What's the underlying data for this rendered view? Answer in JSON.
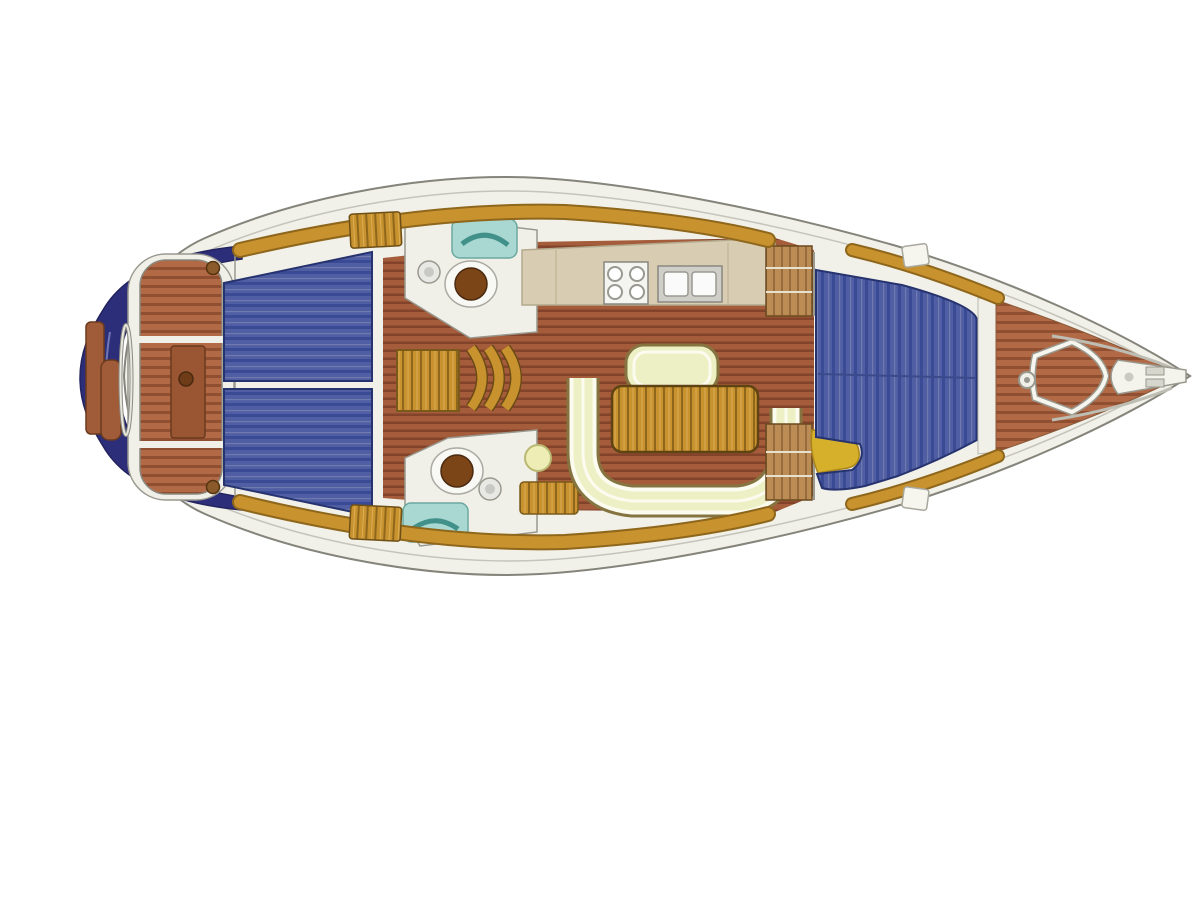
{
  "diagram": {
    "type": "sailboat-interior-floor-plan",
    "orientation": "bow-right",
    "areas": [
      "swim-platform",
      "transom",
      "cockpit",
      "helm-wheel",
      "cockpit-table",
      "aft-cabin-port-berth",
      "aft-cabin-starboard-berth",
      "head-port",
      "head-starboard",
      "galley",
      "stove",
      "double-sink",
      "companionway-steps",
      "salon-floor",
      "salon-table",
      "salon-settee",
      "settee-back-bench",
      "stool",
      "forward-wardrobe-port",
      "forward-wardrobe-starboard",
      "v-berth",
      "v-berth-seat",
      "foredeck",
      "anchor-locker-hatch",
      "windlass",
      "bow-fitting"
    ]
  },
  "colors": {
    "bg": "#ffffff",
    "hull_fill": "#f2f1e9",
    "hull_stroke": "#84847a",
    "deck_line": "#b8b7ac",
    "transom_navy": "#2d2e7a",
    "platform_navy_light": "#7078b4",
    "platform_wood": "#a05c38",
    "teak_base": "#b26a46",
    "teak_stripe": "#914f31",
    "teak_dark_box": "#9a5532",
    "floor_base": "#a55c3a",
    "floor_stripe": "#83432a",
    "berth_base": "#505fa3",
    "berth_stripe": "#3a4a94",
    "berth_light": "#707aae",
    "berth_outline": "#26336f",
    "white_detail": "#f1f0e8",
    "gray_detail": "#98988e",
    "gold_wood": "#c8922e",
    "gold_dark": "#8f671c",
    "gold_light": "#dcae55",
    "counter_beige": "#d8cdb2",
    "counter_stroke": "#b3a98d",
    "stove_white": "#f4f4f0",
    "sink_gray": "#d0cec8",
    "teal": "#a8d8d1",
    "teal_dark": "#41918a",
    "toilet_brown": "#7b4518",
    "settee_cream": "#edf0c4",
    "settee_edge": "#857440",
    "settee_white": "#fbfbf0",
    "stool_fill": "#ededb5",
    "stool_stroke": "#b9b973",
    "seat_yellow": "#d7b02b",
    "seat_yellow_dark": "#a8841a",
    "cabinet_wood": "#bb8d55",
    "cabinet_stripe": "#976b3c",
    "winch_brown": "#8a5a2a",
    "pedestal_brown": "#6e3d18"
  }
}
